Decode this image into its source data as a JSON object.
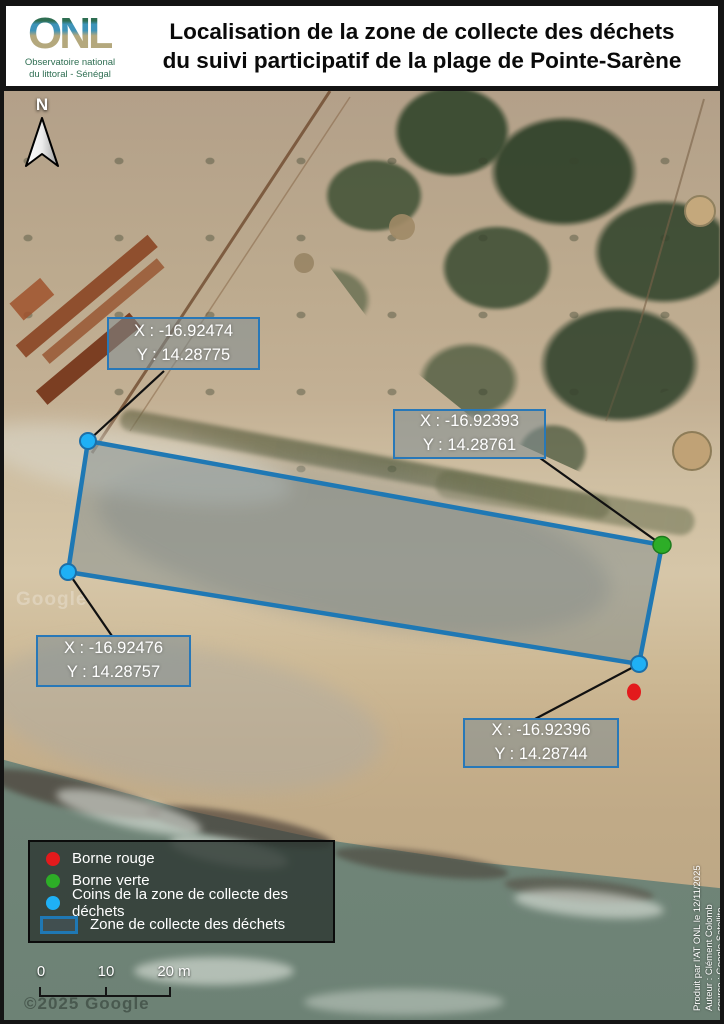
{
  "header": {
    "logo_acronym": "ONL",
    "logo_subtitle_line1": "Observatoire national",
    "logo_subtitle_line2": "du littoral - Sénégal",
    "title_line1": "Localisation de la zone de collecte des déchets",
    "title_line2": "du suivi participatif de la plage de Pointe-Sarène"
  },
  "map": {
    "north_label": "N",
    "callouts": [
      {
        "corner": "northwest",
        "x_label": "X : -16.92474",
        "y_label": "Y : 14.28775"
      },
      {
        "corner": "northeast",
        "x_label": "X : -16.92393",
        "y_label": "Y : 14.28761"
      },
      {
        "corner": "southwest",
        "x_label": "X : -16.92476",
        "y_label": "Y : 14.28757"
      },
      {
        "corner": "southeast",
        "x_label": "X : -16.92396",
        "y_label": "Y : 14.28744"
      }
    ],
    "marker_colors": {
      "borne_rouge": "#e31a1c",
      "borne_verte": "#2dad27",
      "zone_corner": "#1fb0f5",
      "zone_outline": "#1f78b4"
    },
    "watermark_center": "Google",
    "watermark_bottom": "©2025 Google"
  },
  "legend": {
    "items": [
      {
        "swatch": "red-dot",
        "color": "#e31a1c",
        "label": "Borne rouge"
      },
      {
        "swatch": "green-dot",
        "color": "#2dad27",
        "label": "Borne verte"
      },
      {
        "swatch": "cyan-dot",
        "color": "#1fb0f5",
        "label": "Coins de la zone de collecte des déchets"
      },
      {
        "swatch": "zone-rectangle",
        "color": "#1f78b4",
        "label": "Zone de collecte des déchets"
      }
    ]
  },
  "scalebar": {
    "labels": [
      "0",
      "10",
      "20 m"
    ]
  },
  "credits": {
    "line1": "Produit par l'AT ONL le 12/11/2025",
    "line2": "Auteur : Clément Colomb",
    "line3": "source : Google Satellite"
  }
}
